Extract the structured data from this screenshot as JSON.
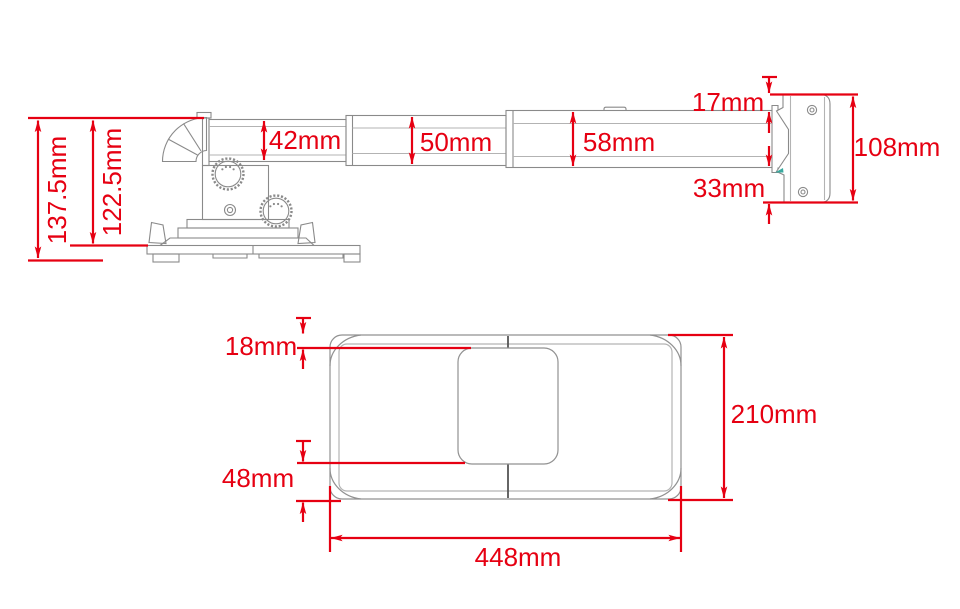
{
  "diagram": {
    "type": "technical dimension drawing",
    "subject": "telescopic projector wall/ceiling mount bracket",
    "units": "mm",
    "colors": {
      "dimension_red": "#e60012",
      "drawing_gray": "#8a8a8a",
      "centerline_dark": "#555555",
      "highlight_teal": "#3aa99f"
    }
  },
  "side_view": {
    "overall_height": "137.5mm",
    "base_top_height": "122.5mm",
    "arm_section_1": "42mm",
    "arm_section_2": "50mm",
    "arm_section_3": "58mm",
    "wall_plate_top_offset": "17mm",
    "wall_plate_bottom_offset": "33mm",
    "wall_plate_height": "108mm"
  },
  "top_view": {
    "bracket_top_inset": "18mm",
    "bracket_bottom_inset": "48mm",
    "plate_depth": "210mm",
    "plate_width": "448mm"
  }
}
